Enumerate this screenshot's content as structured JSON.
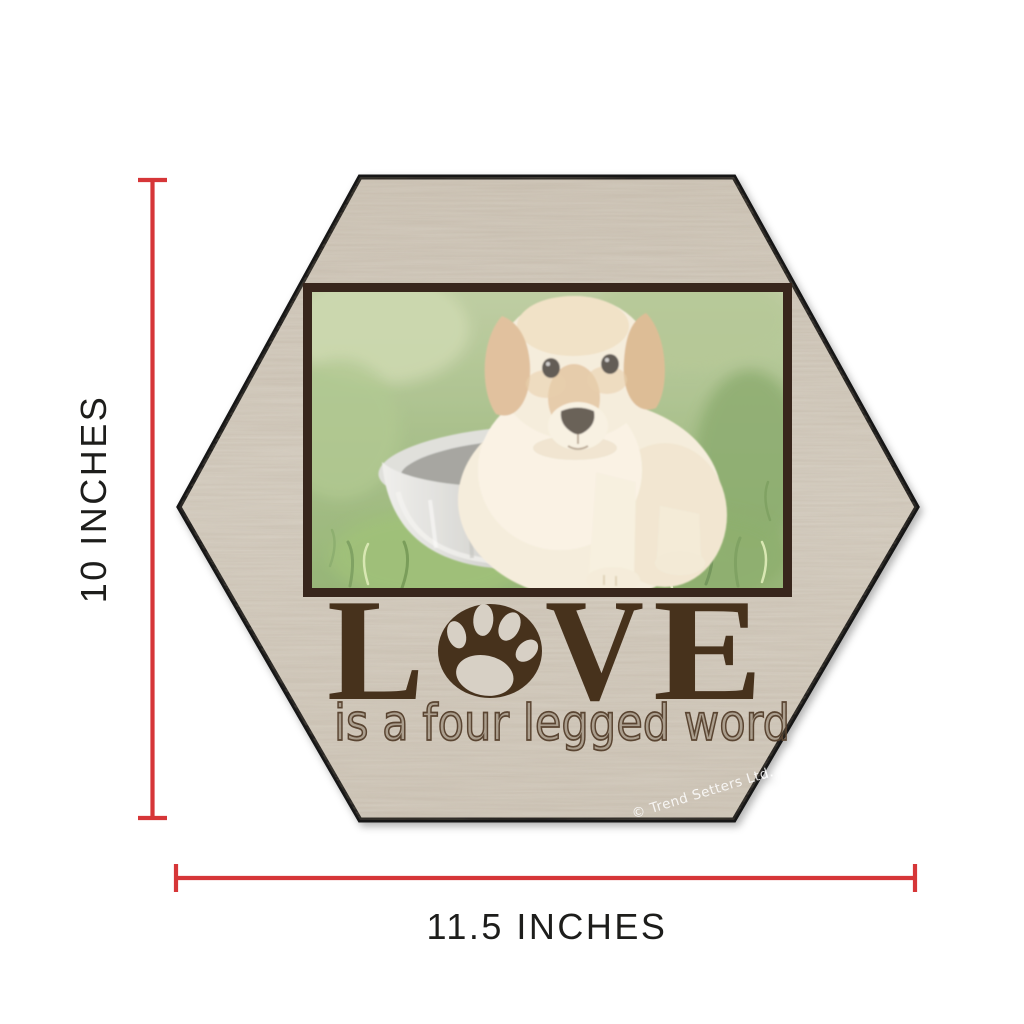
{
  "product_image": {
    "description": "hexagon wood sign product with size measurements",
    "sign": {
      "love_letter_l": "L",
      "love_letter_v": "V",
      "love_letter_e": "E",
      "love_o_icon": "paw-print-in-circle",
      "subtitle": "is a four legged word",
      "watermark": "© Trend Setters Ltd.",
      "photo_subject": "golden retriever puppy sitting in a metal dog bowl on grass"
    },
    "dimensions": {
      "height_label": "10 INCHES",
      "width_label": "11.5 INCHES"
    },
    "colors": {
      "measure_red": "#d63638",
      "dimension_text": "#1d1d1b",
      "love_brown": "#46311f",
      "subtitle_brown": "#5a4430",
      "photo_frame_brown": "#38281a",
      "wood_base": "#d9d2c6",
      "sign_outline": "#121212",
      "watermark_white": "#ffffff"
    }
  }
}
